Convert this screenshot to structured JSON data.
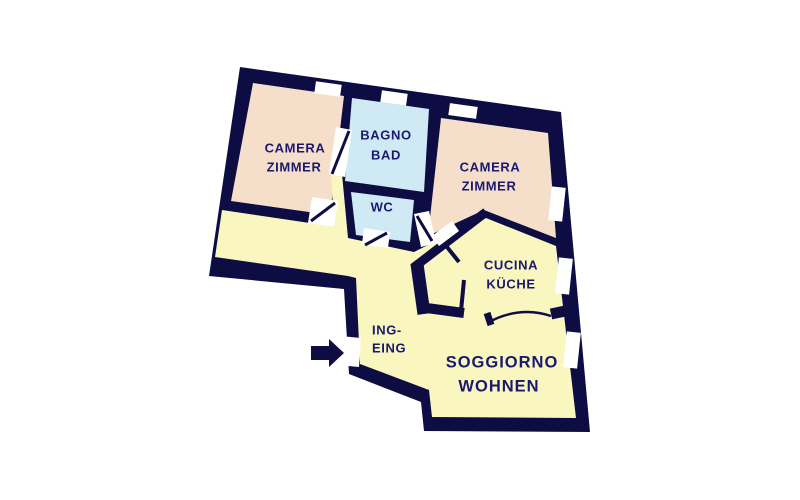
{
  "floorplan": {
    "colors": {
      "wall": "#0d0d44",
      "label": "#191970",
      "bedroom": "#f6dfca",
      "bathroom": "#cfe9f5",
      "living_area": "#faf6c0",
      "opening": "#ffffff",
      "background": "#ffffff"
    },
    "rooms": {
      "bedroom_left": {
        "line1": "CAMERA",
        "line2": "ZIMMER"
      },
      "bathroom": {
        "line1": "BAGNO",
        "line2": "BAD"
      },
      "wc": {
        "line1": "WC"
      },
      "bedroom_right": {
        "line1": "CAMERA",
        "line2": "ZIMMER"
      },
      "kitchen": {
        "line1": "CUCINA",
        "line2": "KÜCHE"
      },
      "entrance_hall": {
        "line1": "ING-",
        "line2": "EING"
      },
      "living_room": {
        "line1": "SOGGIORNO",
        "line2": "WOHNEN"
      }
    },
    "features": {
      "window_count": 6,
      "entrance_marker": "arrow pointing right at entrance door"
    }
  }
}
